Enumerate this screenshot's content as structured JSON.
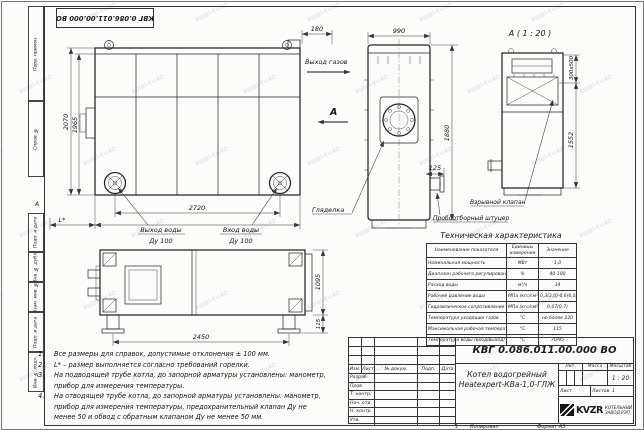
{
  "sheet": {
    "watermark": "kotel-kv.kz",
    "zone_letter_left": "А",
    "zone_number_bottom": "1",
    "copy_label": "Копировал",
    "format_label": "Формат А3"
  },
  "margin_labels": [
    "Перв. примен.",
    "Справ. №",
    "Подп. и дата",
    "Инв. № дубл.",
    "Взам. инв. №",
    "Подп. и дата",
    "Инв. № подл."
  ],
  "drawing": {
    "dims": {
      "front_height": "2070",
      "front_height_inner": "1965",
      "front_width_inner": "2720",
      "front_width_outer": "2980",
      "front_l": "L*",
      "flue_offset": "180",
      "side_width": "990",
      "side_height": "1880",
      "sampler_offset": "125",
      "valve_size": "300х500",
      "detail_height": "1552",
      "top_length": "2450",
      "top_width": "1095",
      "foot_height": "115"
    },
    "labels": {
      "gas_out": "Выход газов",
      "section": "А",
      "detail_title": "А ( 1 : 20 )",
      "water_out_line1": "Выход воды",
      "water_out_line2": "Ду 100",
      "water_in_line1": "Вход воды",
      "water_in_line2": "Ду 100",
      "sight_glass": "Гляделка",
      "sampler": "Пробоотборный штуцер",
      "explosion_valve": "Взрывной клапан"
    }
  },
  "notes": [
    {
      "num": "1.",
      "text": "Все размеры для справок, допустимые отклонения ± 100 мм."
    },
    {
      "num": "2.",
      "text": "L* – размер выполняется согласно требований горелки."
    },
    {
      "num": "3.",
      "text": "На подводящей трубе котла, до запорной арматуры установлены: манометр, прибор для измерения температуры."
    },
    {
      "num": "4.",
      "text": "На отводящей трубе котла, до запорной арматуры установлены: манометр, прибор для измерения температуры, предохранительный клапан Ду не менее 50 и обвод с обратным клапаном Ду не менее 50 мм."
    }
  ],
  "spec_table": {
    "title": "Техническая характеристика",
    "headers": [
      "Наименование показателя",
      "Единицы измерения",
      "Значение"
    ],
    "rows": [
      [
        "Номинальная мощность",
        "МВт",
        "1,0"
      ],
      [
        "Диапазон рабочего регулирования",
        "%",
        "40-100"
      ],
      [
        "Расход воды",
        "м³/ч",
        "34"
      ],
      [
        "Рабочее давление воды",
        "МПа (кгс/см²)",
        "0,3(3,0)-0,6(6,0)"
      ],
      [
        "Гидравлическое сопротивление котла",
        "МПа (кгс/см²)",
        "0,07(0,7)"
      ],
      [
        "Температура уходящих газов",
        "°С",
        "не более 220"
      ],
      [
        "Максимальная рабочая температура воды",
        "°С",
        "115"
      ],
      [
        "Температура воды (вход/выход)",
        "°С",
        "70/95"
      ]
    ]
  },
  "title_block": {
    "doc_number": "КВГ 0.086.011.00.000 ВО",
    "title_line1": "Котел водогрейный",
    "title_line2": "Heatexpert-КВа-1,0-ГЛЖ",
    "header_cols": [
      "Изм.",
      "Лист",
      "№ докум.",
      "Подп.",
      "Дата"
    ],
    "sig_rows": [
      "Разраб.",
      "Пров.",
      "Т. контр.",
      "Нач. отд.",
      "Н. контр.",
      "Утв."
    ],
    "lit_label": "Лит.",
    "mass_label": "Масса",
    "scale_label": "Масштаб",
    "scale_value": "1 : 20",
    "sheet_label": "Лист",
    "sheets_label": "Листов",
    "sheets_value": "1",
    "logo_text": "KVZR",
    "company_line1": "КОТЕЛЬНЫЙ",
    "company_line2": "ЗАВОД РЭП"
  }
}
